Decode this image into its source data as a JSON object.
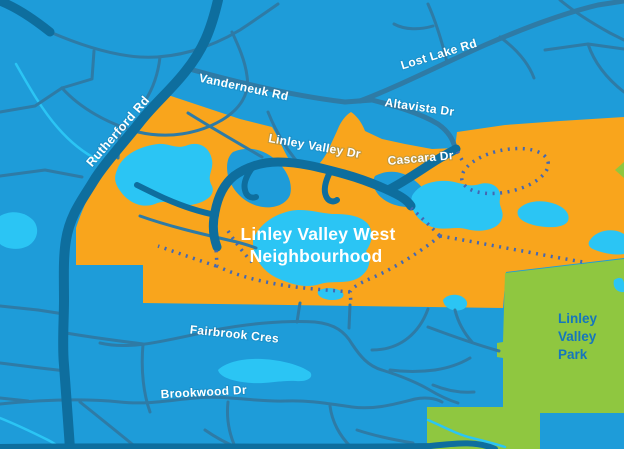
{
  "map": {
    "title": {
      "line1": "Linley Valley West",
      "line2": "Neighbourhood"
    },
    "park": {
      "line1": "Linley",
      "line2": "Valley",
      "line3": "Park"
    },
    "roads": {
      "rutherford": "Rutherford Rd",
      "vanderneuk": "Vanderneuk Rd",
      "lost_lake": "Lost Lake Rd",
      "altavista": "Altavista Dr",
      "linley_valley": "Linley Valley Dr",
      "cascara": "Cascara Dr",
      "fairbrook": "Fairbrook Cres",
      "brookwood": "Brookwood Dr"
    },
    "colors": {
      "bg": "#1E9CD9",
      "neighbourhood": "#F9A51C",
      "park": "#8FC740",
      "lake": "#2BC5F4",
      "road-minor": "#2E7BA6",
      "road-major": "#0E6E9E",
      "trail": "#4468B2",
      "park-label": "#1576BD",
      "road-label": "#FFFFFF"
    }
  }
}
